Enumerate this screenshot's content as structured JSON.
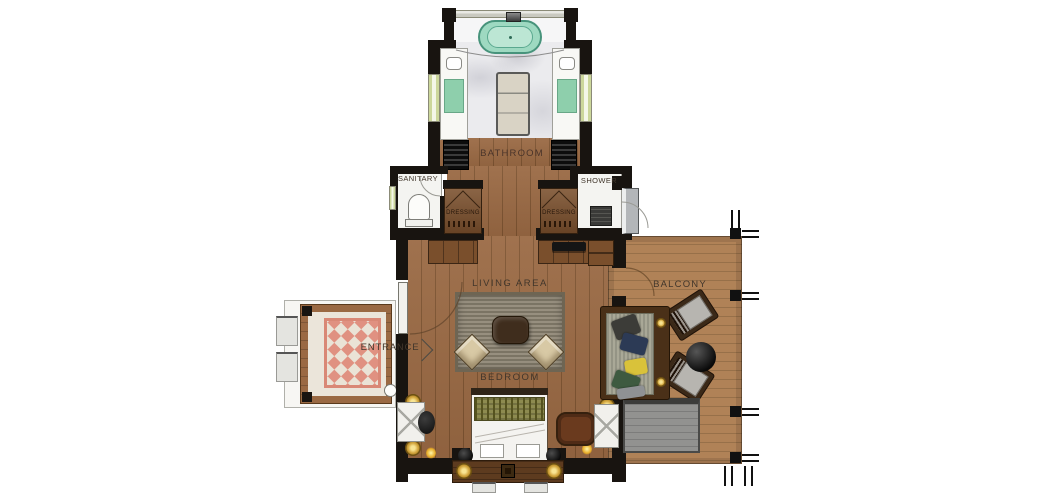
{
  "plan_title": "villa-suite-floor-plan",
  "rooms": {
    "bathroom": {
      "label": "BATHROOM"
    },
    "sanitary": {
      "label": "SANITARY"
    },
    "shower": {
      "label": "SHOWER"
    },
    "dressing_left": {
      "label": "DRESSING"
    },
    "dressing_right": {
      "label": "DRESSING"
    },
    "living_area": {
      "label": "LIVING AREA"
    },
    "bedroom": {
      "label": "BEDROOM"
    },
    "entrance": {
      "label": "ENTRANCE"
    },
    "balcony": {
      "label": "BALCONY"
    }
  },
  "colors": {
    "wall": "#181410",
    "wood": "#9a6943",
    "wood_seam": "#7d5330",
    "deck": "#b08257",
    "deck_seam": "#977049",
    "marble": "#ebebee",
    "white_floor": "#f4f4f1",
    "cream": "#ebe5da",
    "tub": "#9ed9c1",
    "tub_border": "#47937b",
    "tub_inner": "#bce6d4",
    "vanity_green": "#7cc9a0",
    "island": "#d9d3c5",
    "rug_living": "#8f8775",
    "rug_living_border": "#6e6553",
    "rug_entrance": "#e09181",
    "rug_entrance_alt": "#eae3d6",
    "rug_entrance_border": "#d98876",
    "table_dark": "#3f2d1d",
    "chair_beige": "#d8c9a5",
    "bed_white": "#f4f3f0",
    "blanket": "#8d8b50",
    "blanket_dark": "#55531f",
    "console_wood": "#5d3b1f",
    "gold": "#d2a43c",
    "mattress": "#a9a897",
    "mat_gray": "#929290",
    "panel_gray": "#b3b6b9",
    "dresser_wood": "#7a4f2c",
    "label": "#41362b"
  }
}
